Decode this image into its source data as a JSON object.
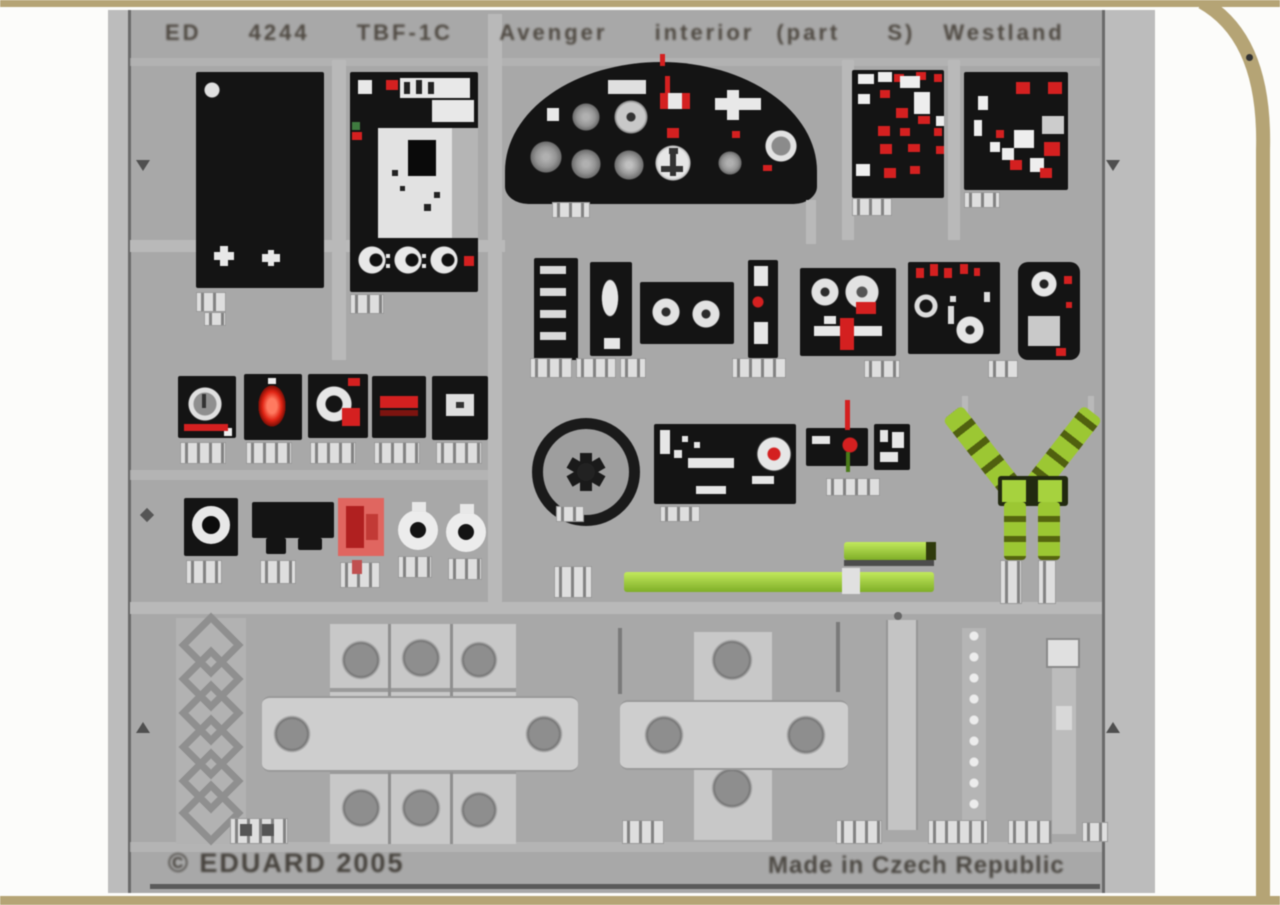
{
  "caption": {
    "left": "ED 4244 TBF-1C Avenger interior",
    "mid": "(part S)",
    "right": "Westland"
  },
  "footer": {
    "copyright": "© EDUARD 2005",
    "made_in": "Made in Czech Republic"
  },
  "colors": {
    "border_tan": "#b5a475",
    "page_white": "#fcfcfa",
    "fret_grey": "#a8a8a8",
    "plate_light": "#c8c8c8",
    "panel_black": "#141414",
    "accent_red": "#d42020",
    "harness_green": "#9cc733",
    "tab_white": "#dedede"
  },
  "parts": [
    "pilot-instrument-panel",
    "side-console-panel",
    "radio-panel",
    "switch-panel-left",
    "switch-panel-right",
    "auxiliary-panels",
    "gauge-squares",
    "control-wheel",
    "seat-harness-straps",
    "lap-belt-strips",
    "placard-red",
    "bezel-rings",
    "structural-frame-left",
    "structural-frame-right",
    "seat-frame-lattice",
    "perforated-strips",
    "part-number-tabs",
    "registration-marks"
  ]
}
